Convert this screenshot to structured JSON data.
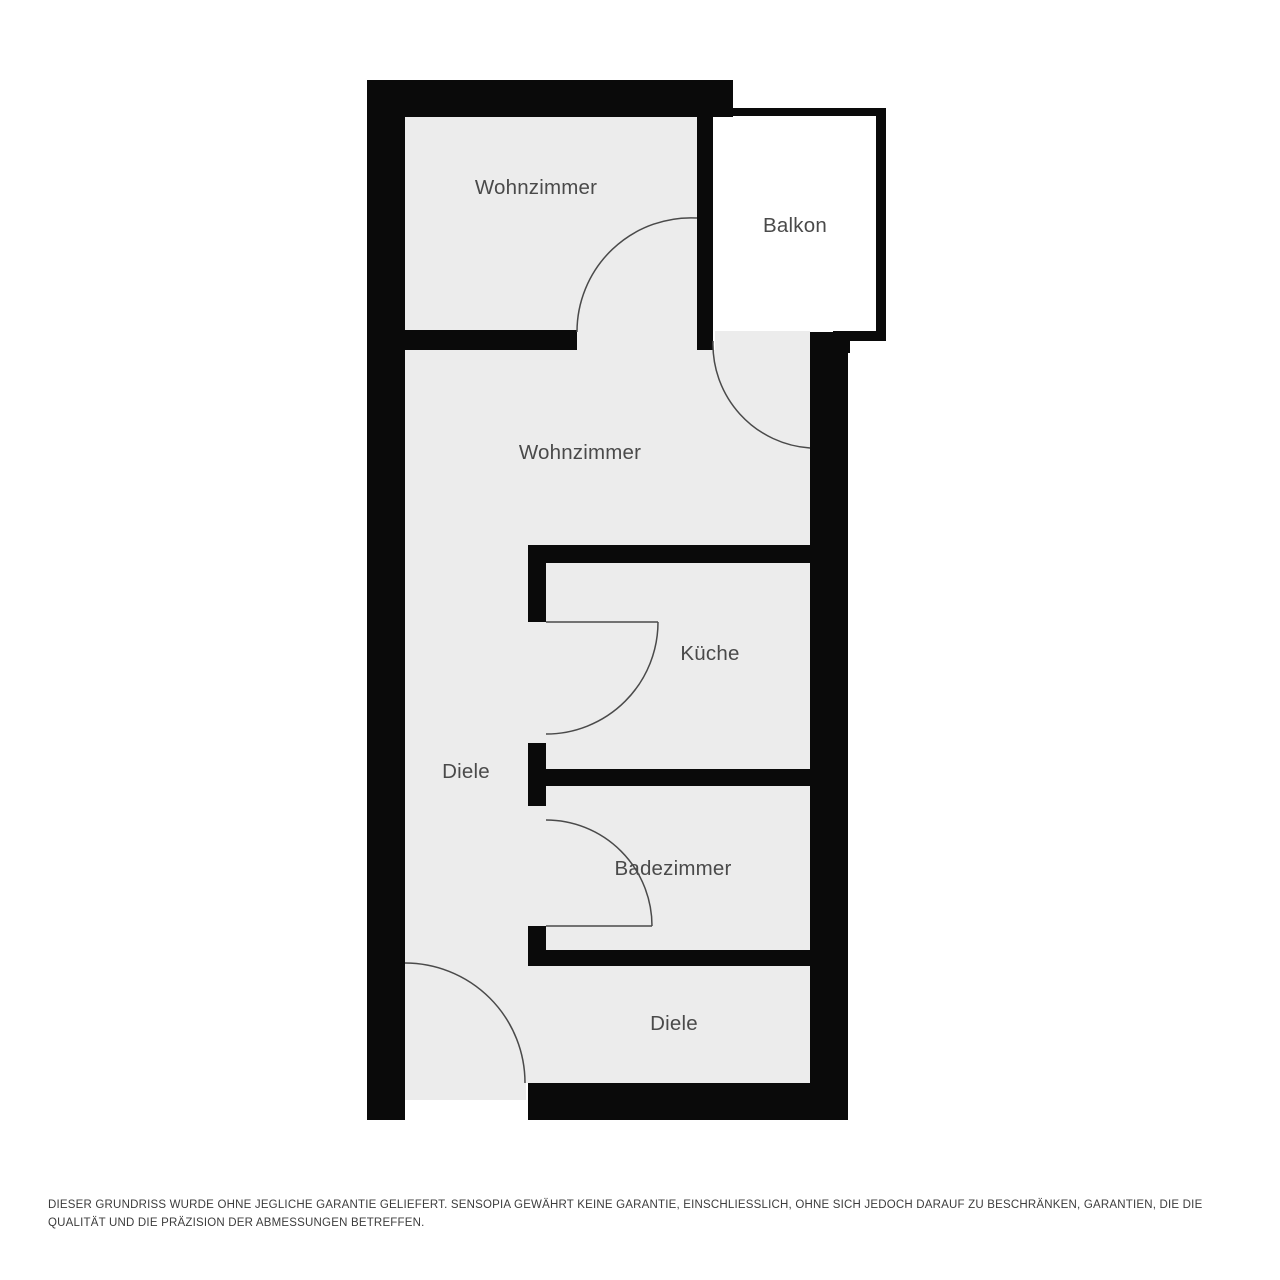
{
  "colors": {
    "wall": "#0a0a0a",
    "room_fill": "#ececec",
    "balcony_fill": "#ffffff",
    "door_line": "#4a4a4a",
    "label_text": "#4a4a4a",
    "disclaimer_text": "#3c3c3c",
    "background": "#ffffff"
  },
  "rooms": [
    {
      "name": "Wohnzimmer"
    },
    {
      "name": "Balkon"
    },
    {
      "name": "Wohnzimmer"
    },
    {
      "name": "Küche"
    },
    {
      "name": "Diele"
    },
    {
      "name": "Badezimmer"
    },
    {
      "name": "Diele"
    }
  ],
  "disclaimer": "DIESER GRUNDRISS WURDE OHNE JEGLICHE GARANTIE GELIEFERT. SENSOPIA GEWÄHRT KEINE GARANTIE, EINSCHLIESSLICH, OHNE SICH JEDOCH DARAUF ZU BESCHRÄNKEN, GARANTIEN, DIE DIE QUALITÄT UND DIE PRÄZISION DER ABMESSUNGEN BETREFFEN."
}
